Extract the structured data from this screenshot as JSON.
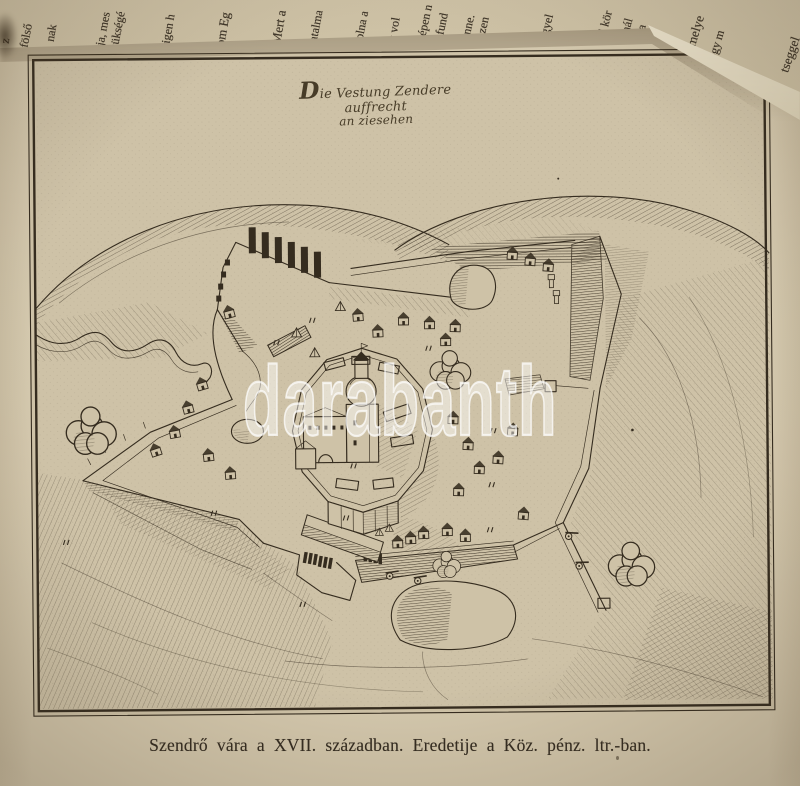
{
  "book": {
    "caption": "Szendrő vára a XVII. században. Eredetije a Köz. pénz. ltr.-ban.",
    "plate": {
      "cartouche_line1": "Die Vestung Zendere auffrecht",
      "cartouche_line2": "an ziesehen"
    },
    "watermark_text": "darabanth",
    "prev_page_fragments": [
      {
        "t": "z",
        "x": 5,
        "y": 36,
        "r": -81
      },
      {
        "t": "fölső",
        "x": 24,
        "y": 40,
        "r": -79
      },
      {
        "t": "nak",
        "x": 50,
        "y": 34,
        "r": -80
      },
      {
        "t": "ja, mes",
        "x": 100,
        "y": 38,
        "r": -79
      },
      {
        "t": "zükségé",
        "x": 114,
        "y": 42,
        "r": -79
      },
      {
        "t": "igen h",
        "x": 166,
        "y": 36,
        "r": -80
      },
      {
        "t": "om Eg",
        "x": 220,
        "y": 38,
        "r": -80,
        "s": 13
      },
      {
        "t": "Mert a",
        "x": 276,
        "y": 36,
        "r": -80,
        "s": 13
      },
      {
        "t": "hatalma",
        "x": 312,
        "y": 40,
        "r": -79
      },
      {
        "t": "volna a",
        "x": 358,
        "y": 38,
        "r": -79
      },
      {
        "t": "k vol",
        "x": 392,
        "y": 34,
        "r": -80
      },
      {
        "t": "szépen n",
        "x": 420,
        "y": 38,
        "r": -78
      },
      {
        "t": "n fund",
        "x": 438,
        "y": 36,
        "r": -78
      },
      {
        "t": "benne.",
        "x": 464,
        "y": 38,
        "r": -77
      },
      {
        "t": "vőszen",
        "x": 478,
        "y": 42,
        "r": -77
      },
      {
        "t": "négyel",
        "x": 542,
        "y": 38,
        "r": -76
      },
      {
        "t": "kal kör",
        "x": 600,
        "y": 36,
        "r": -75
      },
      {
        "t": "hirnál",
        "x": 622,
        "y": 38,
        "r": -75
      },
      {
        "t": ", a ba",
        "x": 636,
        "y": 42,
        "r": -75
      },
      {
        "t": "t, melye",
        "x": 688,
        "y": 48,
        "r": -73,
        "s": 13
      },
      {
        "t": "ogy m",
        "x": 712,
        "y": 52,
        "r": -73
      },
      {
        "t": "tseggel",
        "x": 784,
        "y": 64,
        "r": -71,
        "s": 13
      }
    ],
    "colors": {
      "page_paper": "#d3c7ac",
      "plate_paper": "#cec2a7",
      "ink": "#352c1f",
      "fore_edge": "#ece4cf",
      "watermark": "#ffffff"
    }
  }
}
